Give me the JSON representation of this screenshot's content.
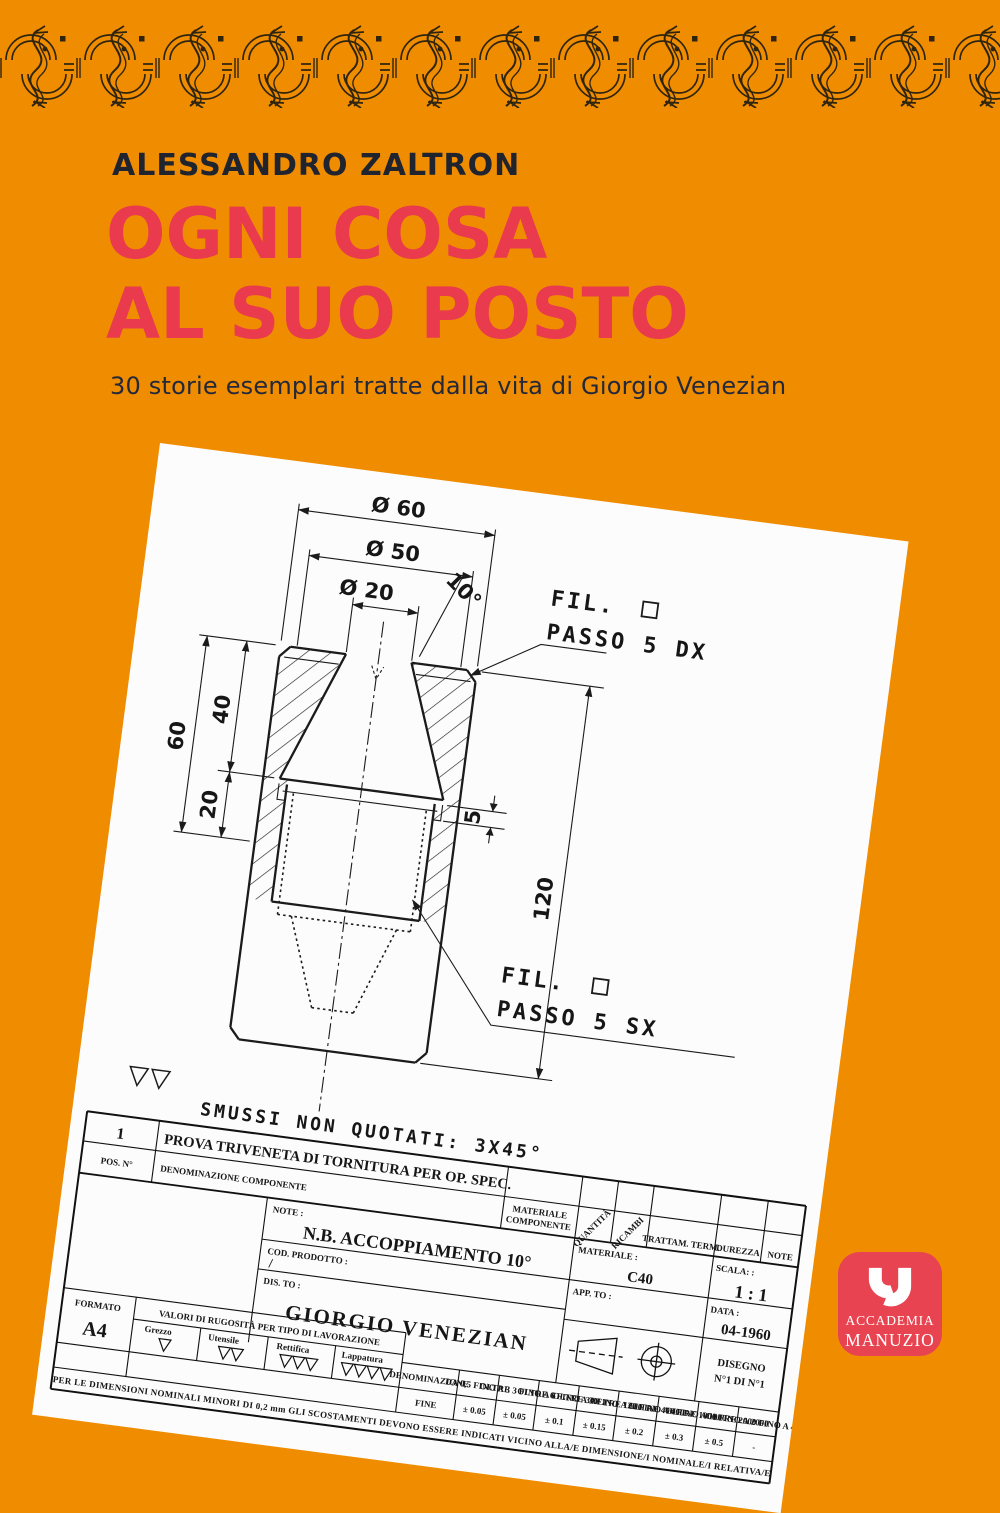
{
  "cover": {
    "author": "ALESSANDRO ZALTRON",
    "title_line1": "OGNI COSA",
    "title_line2": "AL SUO POSTO",
    "subtitle": "30 storie esemplari tratte dalla vita di Giorgio Venezian"
  },
  "colors": {
    "background_orange": "#F08C00",
    "title_red": "#E93A4E",
    "logo_red": "#E84350",
    "ink_dark": "#20242F",
    "paper_white": "#FCFCFC",
    "drawing_line": "#1B1B1B"
  },
  "logo": {
    "line1": "ACCADEMIA",
    "line2": "MANUZIO"
  },
  "drawing": {
    "dims": {
      "d60": "Ø 60",
      "d50": "Ø 50",
      "d20": "Ø 20",
      "angle": "10°",
      "len60": "60",
      "len40": "40",
      "len20": "20",
      "len5": "5",
      "len120": "120"
    },
    "thread_dx": {
      "line1": "FIL.",
      "line2": "PASSO 5 DX"
    },
    "thread_sx": {
      "line1": "FIL.",
      "line2": "PASSO 5 SX"
    },
    "chamfer_note": "SMUSSI NON QUOTATI: 3X45°"
  },
  "titleblock": {
    "pos_value": "1",
    "component_name": "PROVA TRIVENETA DI TORNITURA PER OP. SPEC.",
    "headers": {
      "pos": "POS. N°",
      "denominazione": "DENOMINAZIONE COMPONENTE",
      "materiale1": "MATERIALE",
      "materiale2": "COMPONENTE",
      "quantita": "QUANTITÀ",
      "ricambi": "RICAMBI",
      "trattam": "TRATTAM. TERM.",
      "durezza": "DUREZZA",
      "note": "NOTE"
    },
    "note_label": "NOTE :",
    "note_value": "N.B. ACCOPPIAMENTO 10°",
    "cod_label": "COD. PRODOTTO :",
    "cod_value": "/",
    "dis_label": "DIS. TO :",
    "dis_value": "GIORGIO VENEZIAN",
    "materiale_label": "MATERIALE :",
    "materiale_value": "C40",
    "appto_label": "APP. TO :",
    "scala_label": "SCALA: :",
    "scala_value": "1 : 1",
    "data_label": "DATA :",
    "data_value": "04-1960",
    "disegno_label": "DISEGNO",
    "disegno_value": "N°1 DI N°1",
    "formato_label": "FORMATO",
    "formato_value": "A4",
    "rugosita_title": "VALORI DI RUGOSITÀ PER TIPO DI LAVORAZIONE",
    "rugosita_labels": [
      "Grezzo",
      "Utensile",
      "Rettifica",
      "Lappatura"
    ],
    "tol_denominazione": "DENOMINAZIONE",
    "tol_row_label": "FINE",
    "tol_heads": [
      "DA 0,5 FINO A 3",
      "OLTRE 3 FINO A 6",
      "OLTRE 6 FINO A 30",
      "OLTRE 30 FINO A 120",
      "OLTRE 120 FINO A 400",
      "OLTRE 400 FINO A 1000",
      "OLTRE 1000 FINO A 2000",
      "OLTRE 2000 FINO A 4000"
    ],
    "tol_values": [
      "± 0.05",
      "± 0.05",
      "± 0.1",
      "± 0.15",
      "± 0.2",
      "± 0.3",
      "± 0.5",
      "-"
    ],
    "bottom_note": "PER LE DIMENSIONI NOMINALI MINORI DI 0,2 mm GLI SCOSTAMENTI DEVONO ESSERE INDICATI VICINO ALLA/E DIMENSIONE/I NOMINALE/I RELATIVA/E"
  }
}
